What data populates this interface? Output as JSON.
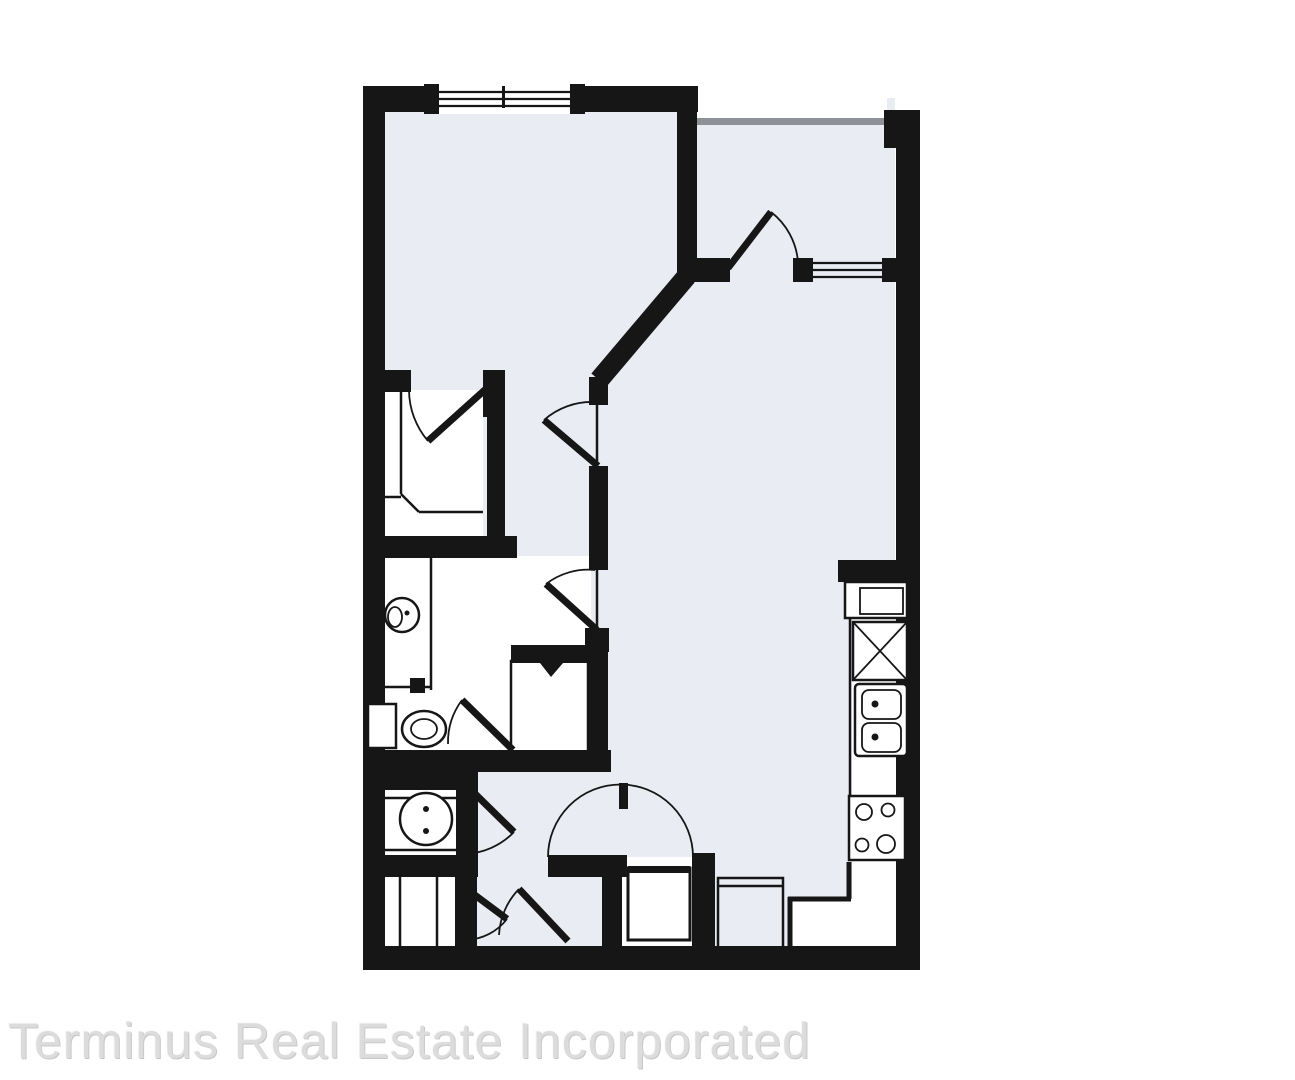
{
  "watermark": {
    "text": "Terminus Real Estate Incorporated"
  },
  "colors": {
    "background": "#ffffff",
    "wall": "#161616",
    "floor": "#e9ecf3",
    "room": "#ffffff",
    "rail": "#8e9296",
    "watermark": "#dcdcdc"
  },
  "floorplan": {
    "type": "one-bedroom-apartment-floor-plan",
    "symbols": [
      "bedroom-window",
      "balcony-railing",
      "balcony-door-swing",
      "balcony-window",
      "closet-bifold-door",
      "closet-shelving",
      "bedroom-door-swing",
      "bath-hall-door-swing",
      "vanity-counter",
      "vanity-sink",
      "toilet",
      "water-closet-door-swing",
      "linen-closet",
      "laundry-door-swing",
      "washer",
      "shelved-closet",
      "entry-door-arc",
      "entry-closet",
      "water-heater",
      "kitchen-stub-wall",
      "refrigerator",
      "pantry-x-box",
      "double-sink",
      "range-stove",
      "kitchen-counter",
      "base-cabinet"
    ]
  }
}
